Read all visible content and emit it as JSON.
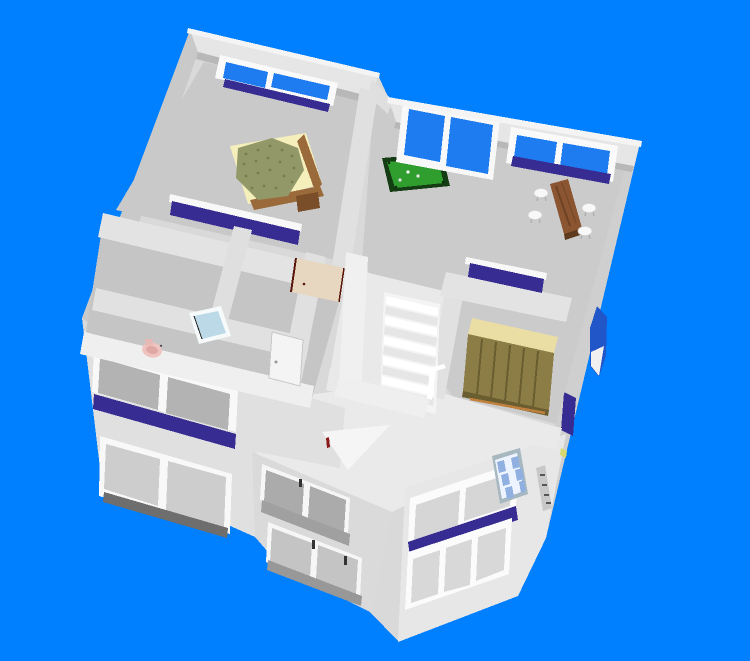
{
  "app": {
    "name": "3d-home-design-viewer",
    "view_mode": "aerial 3d cutaway view"
  },
  "scene": {
    "background": "#007FFF",
    "palette": {
      "wallLight": "#D9D9D9",
      "wallTop": "#E6E6E6",
      "wallFace": "#BDBDBD",
      "wallWhite": "#F2F2F2",
      "floorGray": "#CBCBCB",
      "hallFloor": "#E9E9E9",
      "glassBlue": "#1E7BF0",
      "glassGray": "#B3B3B3",
      "glassPale": "#D6D6D6",
      "sillPurple": "#372C92",
      "sillGray": "#A0A0A0",
      "feltGreen": "#2F9E2F",
      "feltEdge": "#143D14",
      "tableBrown": "#8A5530",
      "chairWhite": "#F8F8F8",
      "bedQuilt": "#939868",
      "bedQuiltDot": "#767C4E",
      "bedLinen": "#F5EFBC",
      "bedFrame": "#9A6A3A",
      "bedFrameDark": "#7A4E28",
      "wardrobeTop": "#EBDEA4",
      "wardrobeBody": "#8C7D46",
      "wardrobeLine": "#6A5E31",
      "tubBlue": "#BCD9E8",
      "toiletPink": "#EFC4C0",
      "doorTan": "#E7D7C0",
      "doorEdgeDark": "#5A150A",
      "skylightBlue": "#8FB0E0",
      "skylightWhite": "#EEF4FF",
      "archBlue": "#2156C8",
      "accentRed": "#8B1A1A",
      "baseboardTan": "#C0803C"
    },
    "upper_floor": {
      "rooms": [
        {
          "name": "Bedroom",
          "furniture": [
            "Double bed with green quilt"
          ],
          "windows": [
            "Back double window",
            "Front sill window"
          ]
        },
        {
          "name": "Billiard and dining room",
          "furniture": [
            "Pool table",
            "Wooden dining table",
            "Four white stools"
          ],
          "windows": [
            "Large picture window",
            "Back double window"
          ]
        },
        {
          "name": "Hallway",
          "features": [
            "Staircase",
            "Open wooden door",
            "White interior door",
            "Balustrade"
          ]
        },
        {
          "name": "Dressing room",
          "furniture": [
            "Wardrobe with plank doors"
          ],
          "windows": [
            "Front sill window"
          ]
        },
        {
          "name": "Bathroom",
          "furniture": [
            "Bathtub",
            "Pink toilet"
          ]
        }
      ]
    },
    "ground_floor": {
      "features": [
        "Left facade band window with purple sill",
        "Left facade lower double window",
        "Center two-story double windows with gray sills",
        "Front-right band window with purple sill",
        "Front-right triple window",
        "Arched blue side window",
        "Purple side sill strip",
        "Checkered roof skylight",
        "Downpipe",
        "White gable fragment"
      ]
    }
  }
}
